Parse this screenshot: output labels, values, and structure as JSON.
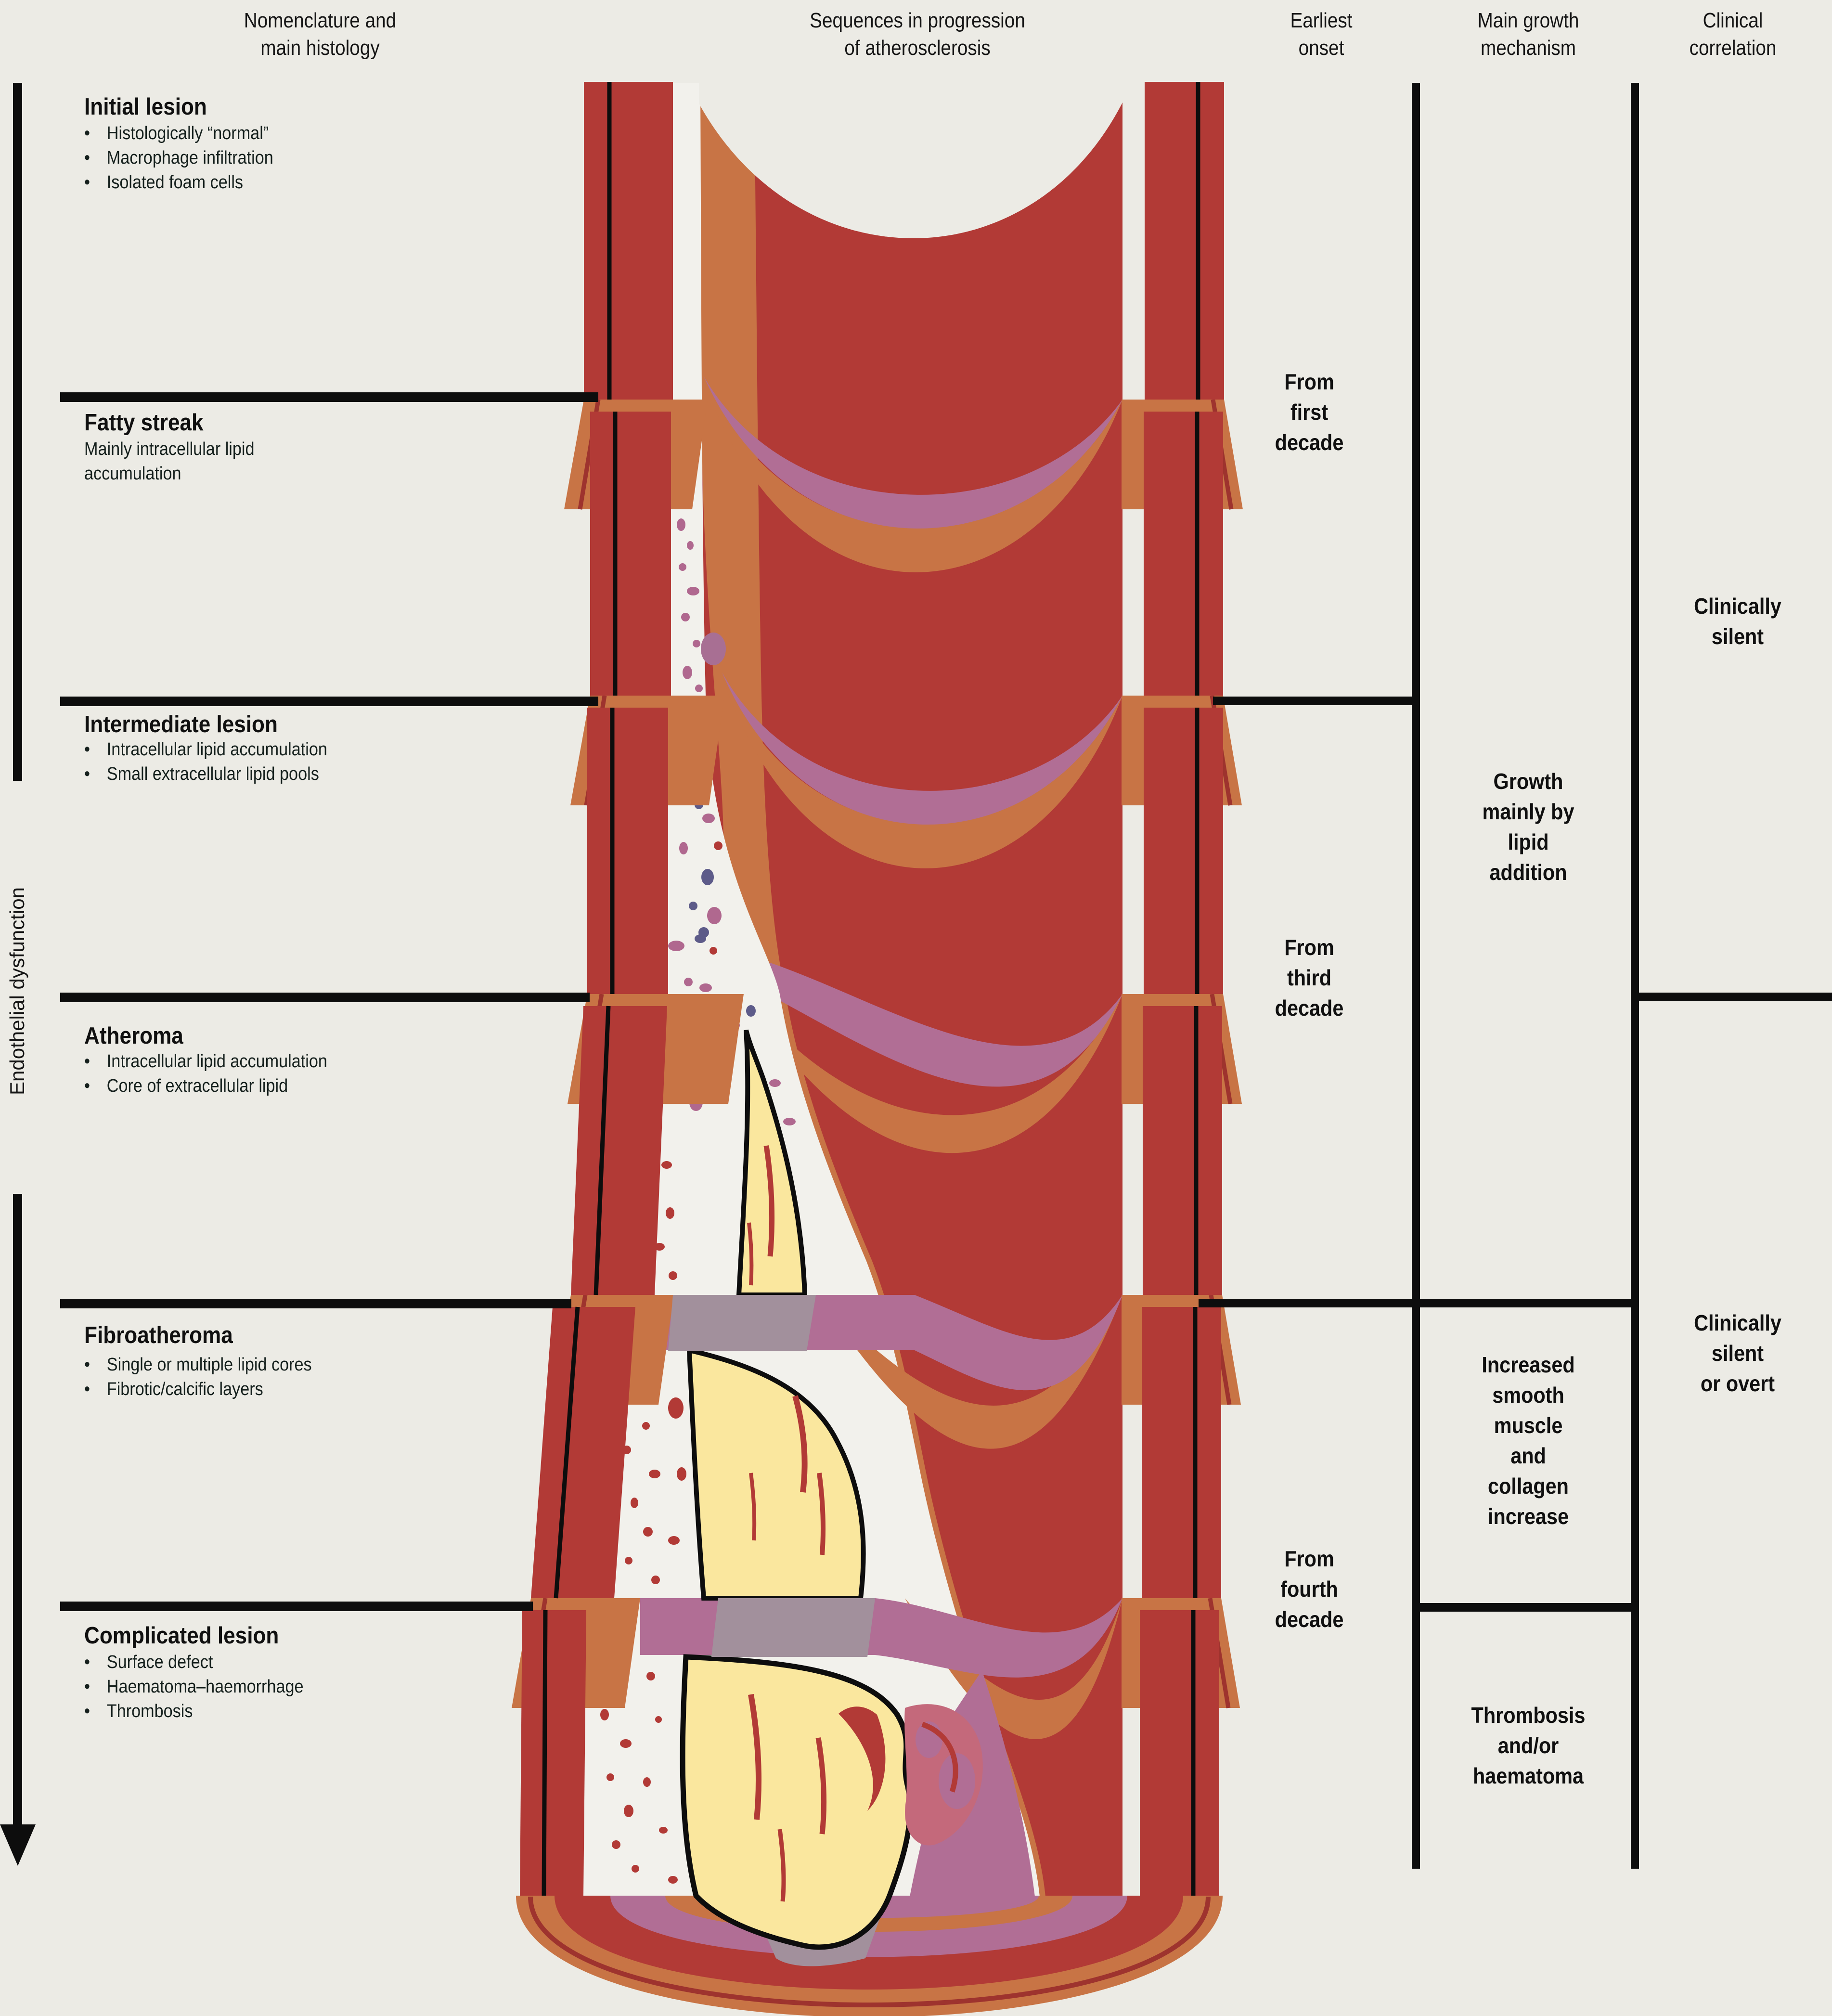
{
  "title": "Sequences in progression of atherosclerosis",
  "palette": {
    "background": "#ECEBE5",
    "wall_red": "#B23A36",
    "media_orange": "#C87445",
    "intima_white": "#F2F1EC",
    "plaque_yellow": "#FAE79E",
    "band_purple": "#B16E95",
    "band_grey": "#A2909C",
    "dark_red_line": "#9E332E",
    "speckle_pink": "#B0688F",
    "speckle_navy": "#5D5B89",
    "thrombus_pink": "#C4697B",
    "line_black": "#0D0D0D"
  },
  "column_headers": {
    "histology": [
      "Nomenclature and",
      "main histology"
    ],
    "sequence": [
      "Sequences in progression",
      "of atherosclerosis"
    ],
    "onset": [
      "Earliest",
      "onset"
    ],
    "growth": [
      "Main growth",
      "mechanism"
    ],
    "clinical": [
      "Clinical",
      "correlation"
    ]
  },
  "axis": {
    "label": "Endothelial dysfunction"
  },
  "stages": [
    {
      "title": "Initial lesion",
      "bullets": [
        "Histologically “normal”",
        "Macrophage infiltration",
        "Isolated foam cells"
      ]
    },
    {
      "title": "Fatty streak",
      "description": [
        "Mainly intracellular lipid",
        "accumulation"
      ]
    },
    {
      "title": "Intermediate lesion",
      "bullets": [
        "Intracellular lipid accumulation",
        "Small extracellular lipid pools"
      ]
    },
    {
      "title": "Atheroma",
      "bullets": [
        "Intracellular lipid accumulation",
        "Core of extracellular lipid"
      ]
    },
    {
      "title": "Fibroatheroma",
      "bullets": [
        "Single or multiple lipid cores",
        "Fibrotic/calcific layers"
      ]
    },
    {
      "title": "Complicated lesion",
      "bullets": [
        "Surface defect",
        "Haematoma–haemorrhage",
        "Thrombosis"
      ]
    }
  ],
  "onset_labels": [
    [
      "From",
      "first",
      "decade"
    ],
    [
      "From",
      "third",
      "decade"
    ],
    [
      "From",
      "fourth",
      "decade"
    ]
  ],
  "growth_labels": [
    [
      "Growth",
      "mainly by",
      "lipid",
      "addition"
    ],
    [
      "Increased",
      "smooth",
      "muscle",
      "and",
      "collagen",
      "increase"
    ],
    [
      "Thrombosis",
      "and/or",
      "haematoma"
    ]
  ],
  "clinical_labels": [
    [
      "Clinically",
      "silent"
    ],
    [
      "Clinically",
      "silent",
      "or overt"
    ]
  ]
}
